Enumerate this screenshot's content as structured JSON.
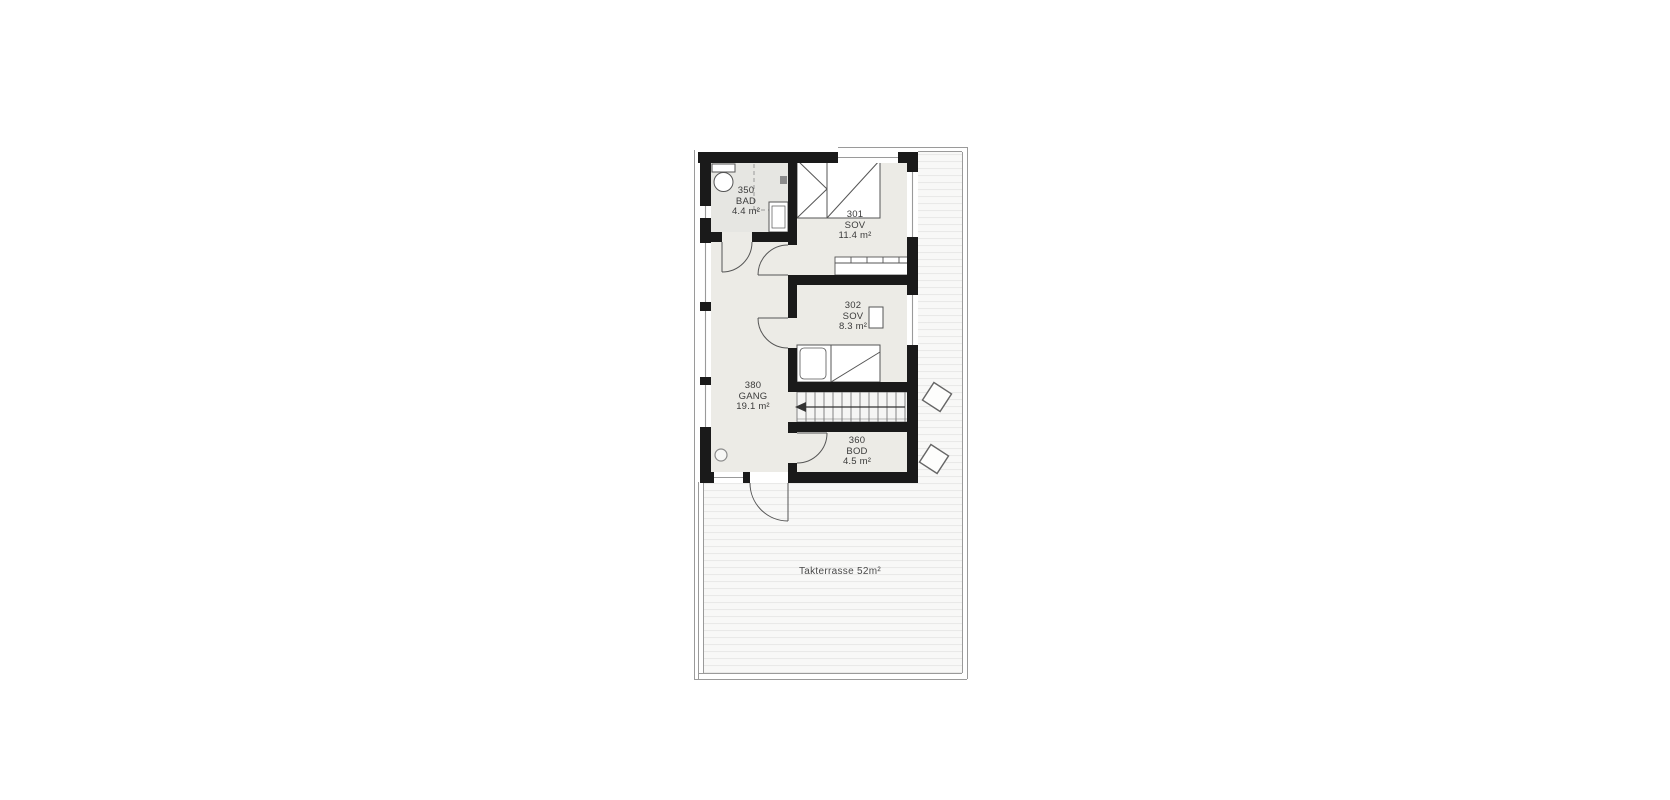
{
  "plan": {
    "rooms": [
      {
        "id": "350",
        "name": "BAD",
        "area": "4.4 m²"
      },
      {
        "id": "301",
        "name": "SOV",
        "area": "11.4 m²"
      },
      {
        "id": "302",
        "name": "SOV",
        "area": "8.3 m²"
      },
      {
        "id": "380",
        "name": "GANG",
        "area": "19.1 m²"
      },
      {
        "id": "360",
        "name": "BOD",
        "area": "4.5 m²"
      }
    ],
    "terrace": {
      "label": "Takterrasse 52m²"
    },
    "colors": {
      "wall": "#1a1a1a",
      "room_fill": "#ecebe6",
      "bath_fill": "#e6e6e2",
      "deck_bg": "#f8f8f7",
      "deck_line": "#e9e9e8",
      "thin_line": "#555555",
      "rail_line": "#999999"
    }
  }
}
